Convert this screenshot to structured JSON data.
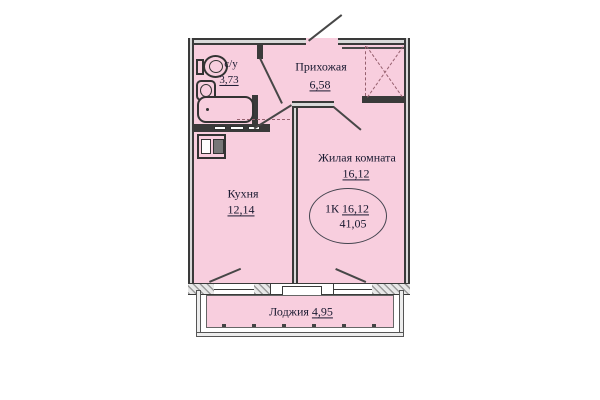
{
  "plan": {
    "type_label": "1К",
    "living_area": "16,12",
    "total_area": "41,05"
  },
  "rooms": {
    "bathroom": {
      "name": "с/у",
      "area": "3,73"
    },
    "hallway": {
      "name": "Прихожая",
      "area": "6,58"
    },
    "living": {
      "name": "Жилая комната",
      "area": "16,12"
    },
    "kitchen": {
      "name": "Кухня",
      "area": "12,14"
    },
    "loggia": {
      "name": "Лоджия",
      "area": "4,95"
    }
  },
  "fixtures": {
    "bathtub": "bathtub-icon",
    "toilet": "toilet-icon",
    "sink": "sink-icon",
    "stove": "stove-icon",
    "wardrobe": "wardrobe-icon",
    "entry_door": "door-swing-icon"
  },
  "colors": {
    "room_fill": "#f8cede",
    "wall": "#3a3a3a",
    "hatch": "#9b9b9b",
    "text": "#191930",
    "dashed_marks": "#96606e"
  }
}
